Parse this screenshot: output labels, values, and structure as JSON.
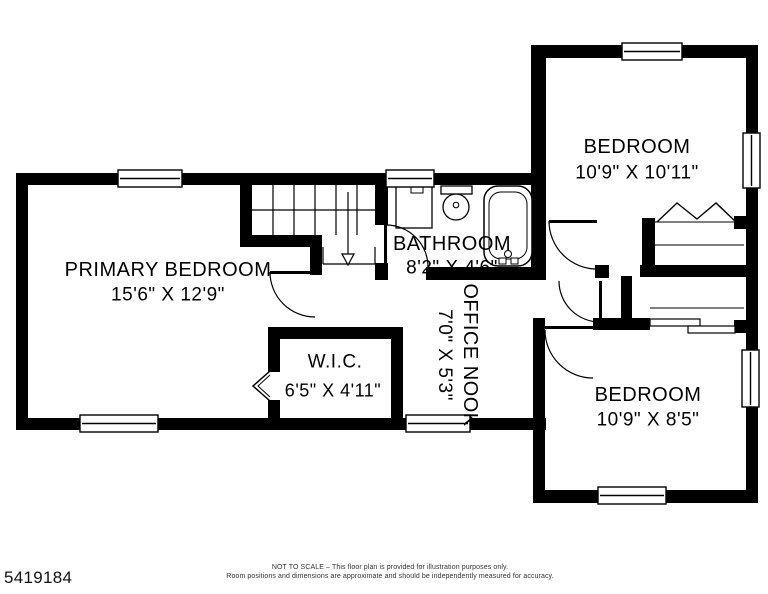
{
  "rooms": {
    "primary_bedroom": {
      "name": "PRIMARY BEDROOM",
      "dims": "15'6\" X 12'9\""
    },
    "bathroom": {
      "name": "BATHROOM",
      "dims": "8'2\" X 4'6\""
    },
    "bedroom_top": {
      "name": "BEDROOM",
      "dims": "10'9\" X 10'11\""
    },
    "wic": {
      "name": "W.I.C.",
      "dims": "6'5\" X 4'11\""
    },
    "office_nook": {
      "name": "OFFICE NOOK",
      "dims": "7'0\" X 5'3\""
    },
    "bedroom_bottom": {
      "name": "BEDROOM",
      "dims": "10'9\" X 8'5\""
    }
  },
  "footer": {
    "listing_id": "5419184",
    "disclaimer_line1": "NOT TO SCALE – This floor plan is provided for illustration purposes only.",
    "disclaimer_line2": "Room positions and dimensions are approximate and should be independently measured for accuracy."
  },
  "colors": {
    "wall": "#000000",
    "background": "#ffffff"
  }
}
